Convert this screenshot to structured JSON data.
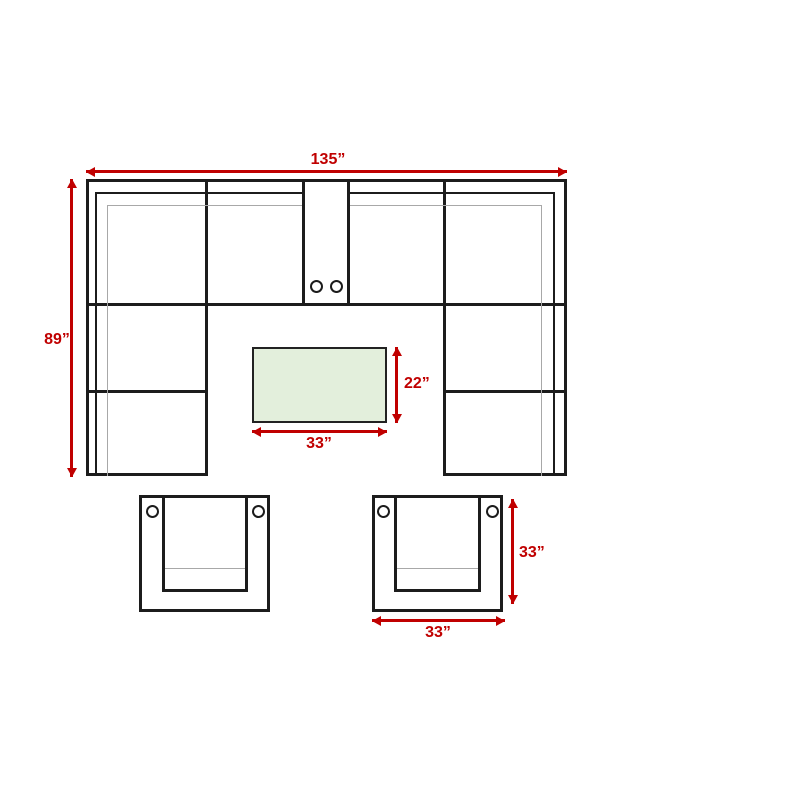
{
  "diagram": {
    "sectional": {
      "width_label": "135”",
      "depth_label": "89”"
    },
    "coffee_table": {
      "width_label": "33”",
      "depth_label": "22”"
    },
    "armchair": {
      "width_label": "33”",
      "depth_label": "33”"
    },
    "colors": {
      "dimension_red": "#c00000",
      "outline_black": "#1c1c1c",
      "cushion_gray": "#a8a8a8",
      "table_fill_green": "#e3efdc"
    }
  }
}
